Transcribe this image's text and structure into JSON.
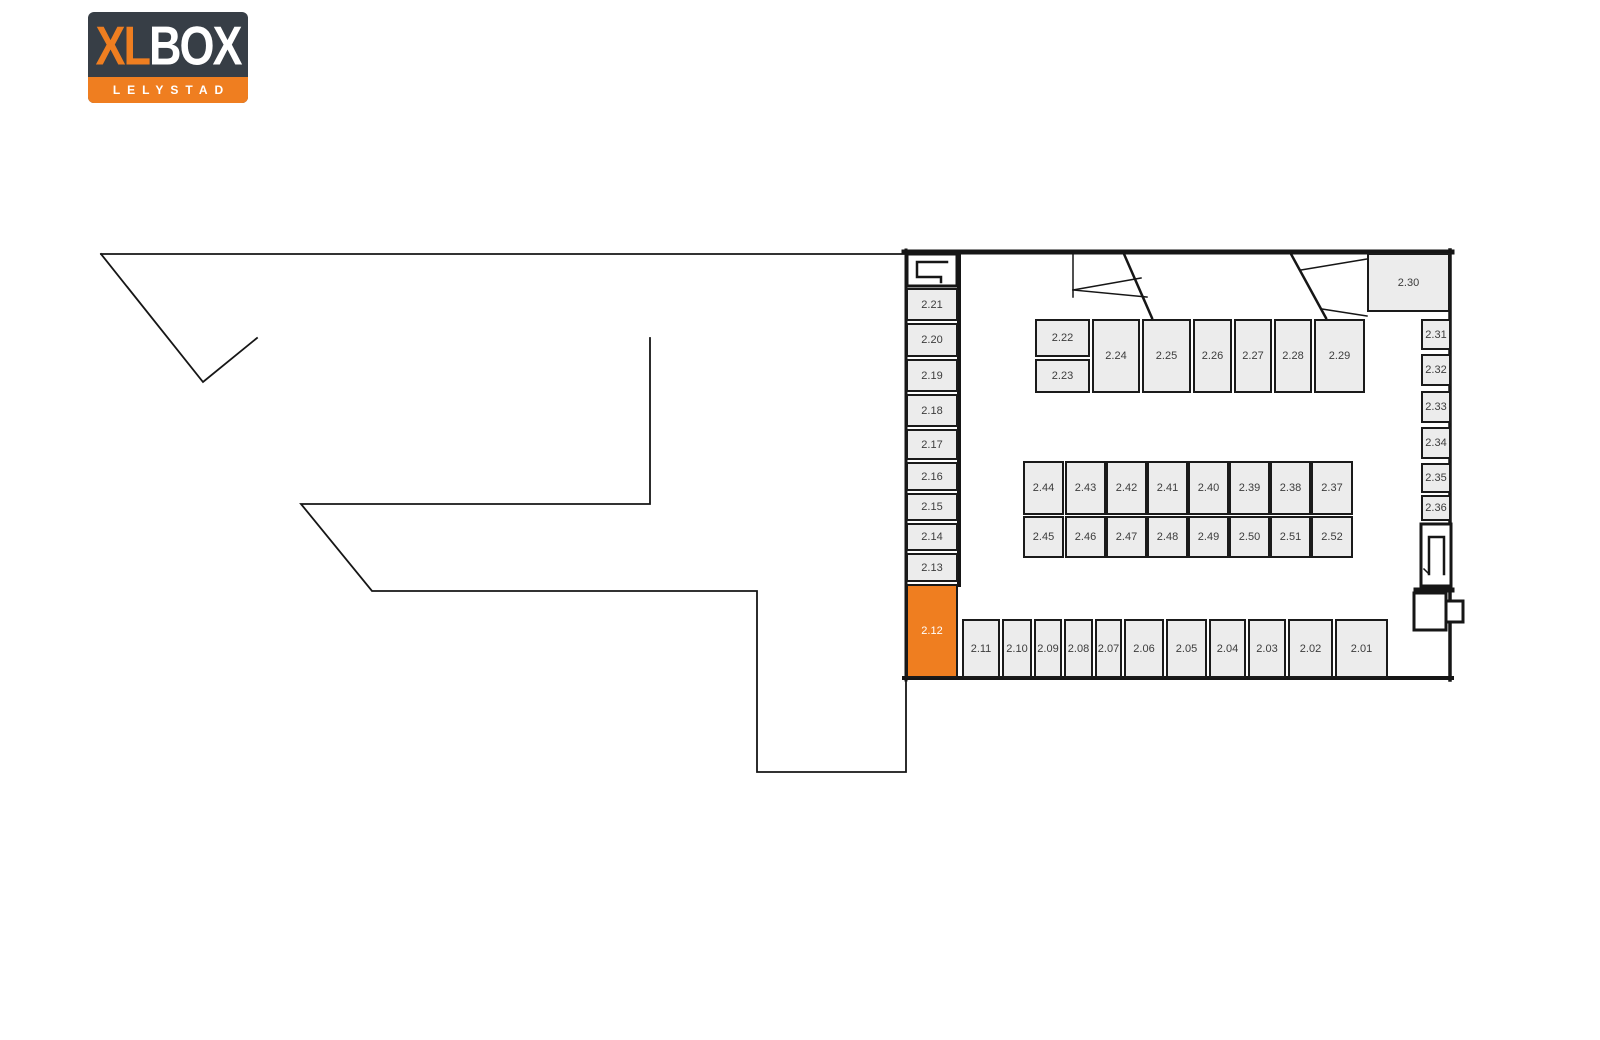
{
  "logo": {
    "text_xl": "XL",
    "text_box": "BOX",
    "subtitle": "LELYSTAD",
    "colors": {
      "dark": "#373e46",
      "orange": "#ef7e20",
      "white": "#ffffff"
    }
  },
  "floorplan": {
    "selected_unit": "2.12",
    "colors": {
      "unit_fill": "#ececec",
      "unit_border": "#1a1a1a",
      "wall": "#161616",
      "label": "#3c3c3c",
      "selected_fill": "#ef7e20",
      "selected_label": "#ffffff"
    },
    "units": [
      {
        "label": "2.21",
        "x": 906,
        "y": 288,
        "w": 52,
        "h": 33
      },
      {
        "label": "2.20",
        "x": 906,
        "y": 323,
        "w": 52,
        "h": 34
      },
      {
        "label": "2.19",
        "x": 906,
        "y": 359,
        "w": 52,
        "h": 33
      },
      {
        "label": "2.18",
        "x": 906,
        "y": 394,
        "w": 52,
        "h": 33
      },
      {
        "label": "2.17",
        "x": 906,
        "y": 429,
        "w": 52,
        "h": 31
      },
      {
        "label": "2.16",
        "x": 906,
        "y": 462,
        "w": 52,
        "h": 29
      },
      {
        "label": "2.15",
        "x": 906,
        "y": 493,
        "w": 52,
        "h": 28
      },
      {
        "label": "2.14",
        "x": 906,
        "y": 523,
        "w": 52,
        "h": 28
      },
      {
        "label": "2.13",
        "x": 906,
        "y": 553,
        "w": 52,
        "h": 29
      },
      {
        "label": "2.12",
        "x": 906,
        "y": 584,
        "w": 52,
        "h": 94,
        "selected": true
      },
      {
        "label": "2.22",
        "x": 1035,
        "y": 319,
        "w": 55,
        "h": 38
      },
      {
        "label": "2.23",
        "x": 1035,
        "y": 359,
        "w": 55,
        "h": 34
      },
      {
        "label": "2.24",
        "x": 1092,
        "y": 319,
        "w": 48,
        "h": 74
      },
      {
        "label": "2.25",
        "x": 1142,
        "y": 319,
        "w": 49,
        "h": 74
      },
      {
        "label": "2.26",
        "x": 1193,
        "y": 319,
        "w": 39,
        "h": 74
      },
      {
        "label": "2.27",
        "x": 1234,
        "y": 319,
        "w": 38,
        "h": 74
      },
      {
        "label": "2.28",
        "x": 1274,
        "y": 319,
        "w": 38,
        "h": 74
      },
      {
        "label": "2.29",
        "x": 1314,
        "y": 319,
        "w": 51,
        "h": 74
      },
      {
        "label": "2.30",
        "x": 1367,
        "y": 253,
        "w": 83,
        "h": 59
      },
      {
        "label": "2.31",
        "x": 1421,
        "y": 319,
        "w": 30,
        "h": 31
      },
      {
        "label": "2.32",
        "x": 1421,
        "y": 354,
        "w": 30,
        "h": 32
      },
      {
        "label": "2.33",
        "x": 1421,
        "y": 391,
        "w": 30,
        "h": 32
      },
      {
        "label": "2.34",
        "x": 1421,
        "y": 427,
        "w": 30,
        "h": 32
      },
      {
        "label": "2.35",
        "x": 1421,
        "y": 463,
        "w": 30,
        "h": 30
      },
      {
        "label": "2.36",
        "x": 1421,
        "y": 495,
        "w": 30,
        "h": 26
      },
      {
        "label": "2.44",
        "x": 1023,
        "y": 461,
        "w": 41,
        "h": 54
      },
      {
        "label": "2.43",
        "x": 1065,
        "y": 461,
        "w": 41,
        "h": 54
      },
      {
        "label": "2.42",
        "x": 1106,
        "y": 461,
        "w": 41,
        "h": 54
      },
      {
        "label": "2.41",
        "x": 1147,
        "y": 461,
        "w": 41,
        "h": 54
      },
      {
        "label": "2.40",
        "x": 1188,
        "y": 461,
        "w": 41,
        "h": 54
      },
      {
        "label": "2.39",
        "x": 1229,
        "y": 461,
        "w": 41,
        "h": 54
      },
      {
        "label": "2.38",
        "x": 1270,
        "y": 461,
        "w": 41,
        "h": 54
      },
      {
        "label": "2.37",
        "x": 1311,
        "y": 461,
        "w": 42,
        "h": 54
      },
      {
        "label": "2.45",
        "x": 1023,
        "y": 516,
        "w": 41,
        "h": 42
      },
      {
        "label": "2.46",
        "x": 1065,
        "y": 516,
        "w": 41,
        "h": 42
      },
      {
        "label": "2.47",
        "x": 1106,
        "y": 516,
        "w": 41,
        "h": 42
      },
      {
        "label": "2.48",
        "x": 1147,
        "y": 516,
        "w": 41,
        "h": 42
      },
      {
        "label": "2.49",
        "x": 1188,
        "y": 516,
        "w": 41,
        "h": 42
      },
      {
        "label": "2.50",
        "x": 1229,
        "y": 516,
        "w": 41,
        "h": 42
      },
      {
        "label": "2.51",
        "x": 1270,
        "y": 516,
        "w": 41,
        "h": 42
      },
      {
        "label": "2.52",
        "x": 1311,
        "y": 516,
        "w": 42,
        "h": 42
      },
      {
        "label": "2.11",
        "x": 962,
        "y": 619,
        "w": 38,
        "h": 59
      },
      {
        "label": "2.10",
        "x": 1002,
        "y": 619,
        "w": 30,
        "h": 59
      },
      {
        "label": "2.09",
        "x": 1034,
        "y": 619,
        "w": 28,
        "h": 59
      },
      {
        "label": "2.08",
        "x": 1064,
        "y": 619,
        "w": 29,
        "h": 59
      },
      {
        "label": "2.07",
        "x": 1095,
        "y": 619,
        "w": 27,
        "h": 59
      },
      {
        "label": "2.06",
        "x": 1124,
        "y": 619,
        "w": 40,
        "h": 59
      },
      {
        "label": "2.05",
        "x": 1166,
        "y": 619,
        "w": 41,
        "h": 59
      },
      {
        "label": "2.04",
        "x": 1209,
        "y": 619,
        "w": 37,
        "h": 59
      },
      {
        "label": "2.03",
        "x": 1248,
        "y": 619,
        "w": 38,
        "h": 59
      },
      {
        "label": "2.02",
        "x": 1288,
        "y": 619,
        "w": 45,
        "h": 59
      },
      {
        "label": "2.01",
        "x": 1335,
        "y": 619,
        "w": 53,
        "h": 59
      }
    ]
  }
}
